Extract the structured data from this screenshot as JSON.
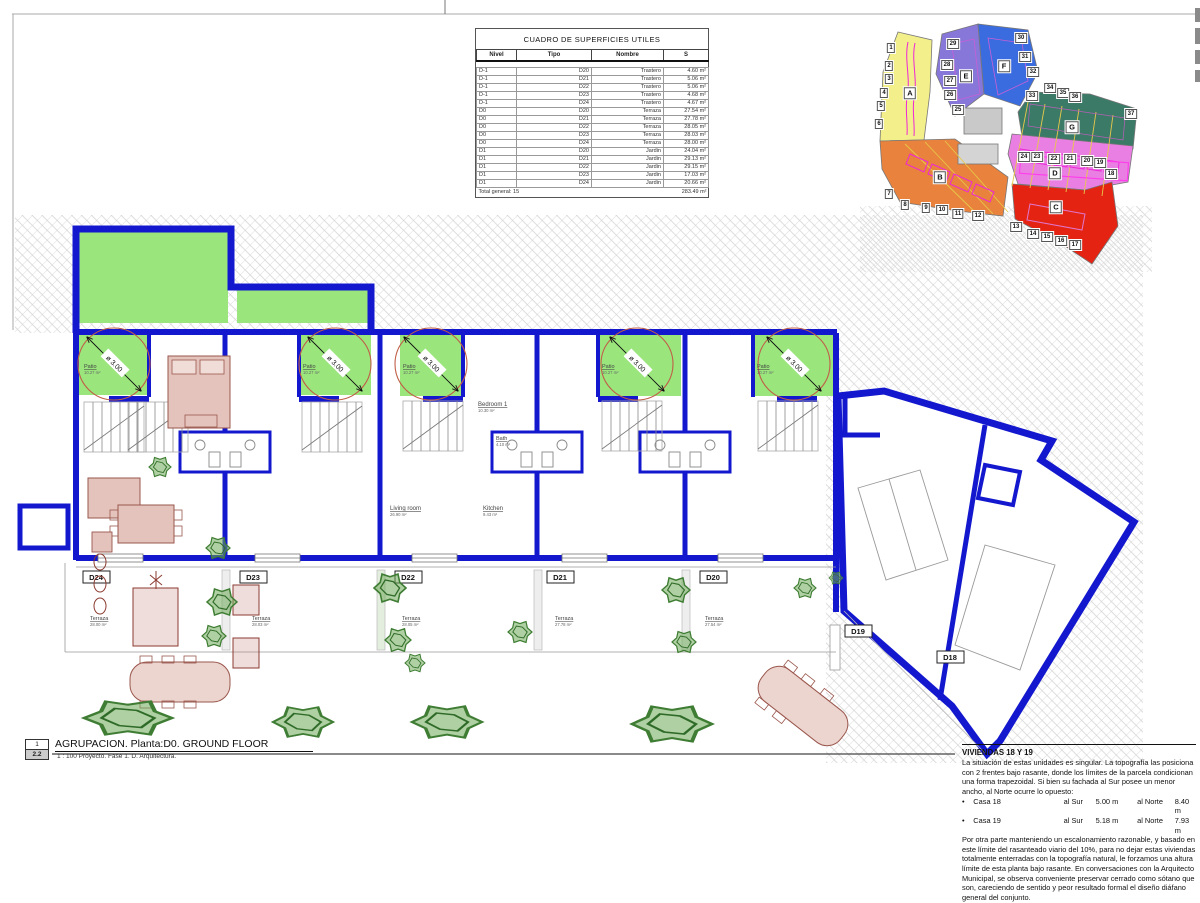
{
  "table": {
    "title": "CUADRO DE SUPERFICIES UTILES",
    "headers": [
      "Nivel",
      "Tipo",
      "Nombre",
      "S"
    ],
    "rows": [
      [
        "D-1",
        "D20",
        "Trastero",
        "4.60 m²"
      ],
      [
        "D-1",
        "D21",
        "Trastero",
        "5.06 m²"
      ],
      [
        "D-1",
        "D22",
        "Trastero",
        "5.06 m²"
      ],
      [
        "D-1",
        "D23",
        "Trastero",
        "4.68 m²"
      ],
      [
        "D-1",
        "D24",
        "Trastero",
        "4.67 m²"
      ],
      [
        "D0",
        "D20",
        "Terraza",
        "27.54 m²"
      ],
      [
        "D0",
        "D21",
        "Terraza",
        "27.78 m²"
      ],
      [
        "D0",
        "D22",
        "Terraza",
        "28.05 m²"
      ],
      [
        "D0",
        "D23",
        "Terraza",
        "28.03 m²"
      ],
      [
        "D0",
        "D24",
        "Terraza",
        "28.00 m²"
      ],
      [
        "D1",
        "D20",
        "Jardin",
        "24.04 m²"
      ],
      [
        "D1",
        "D21",
        "Jardin",
        "29.13 m²"
      ],
      [
        "D1",
        "D22",
        "Jardin",
        "29.15 m²"
      ],
      [
        "D1",
        "D23",
        "Jardin",
        "17.03 m²"
      ],
      [
        "D1",
        "D24",
        "Jardin",
        "20.66 m²"
      ]
    ],
    "total_label": "Total general: 15",
    "total_value": "283.49 m²"
  },
  "site_map": {
    "zones": [
      {
        "letter": "A",
        "color": "#f3ef8a",
        "x": 50,
        "y": 79
      },
      {
        "letter": "B",
        "color": "#e8823c",
        "x": 80,
        "y": 163
      },
      {
        "letter": "C",
        "color": "#e42313",
        "x": 196,
        "y": 193
      },
      {
        "letter": "D",
        "color": "#e97fe3",
        "x": 195,
        "y": 159
      },
      {
        "letter": "E",
        "color": "#8677d8",
        "x": 106,
        "y": 62
      },
      {
        "letter": "F",
        "color": "#3a6ce0",
        "x": 144,
        "y": 52
      },
      {
        "letter": "G",
        "color": "#3c7a68",
        "x": 212,
        "y": 113
      }
    ],
    "plots": [
      {
        "n": "1",
        "x": 31,
        "y": 34
      },
      {
        "n": "2",
        "x": 29,
        "y": 52
      },
      {
        "n": "3",
        "x": 29,
        "y": 65
      },
      {
        "n": "4",
        "x": 24,
        "y": 79
      },
      {
        "n": "5",
        "x": 21,
        "y": 92
      },
      {
        "n": "6",
        "x": 19,
        "y": 110
      },
      {
        "n": "7",
        "x": 29,
        "y": 180
      },
      {
        "n": "8",
        "x": 45,
        "y": 191
      },
      {
        "n": "9",
        "x": 66,
        "y": 194
      },
      {
        "n": "10",
        "x": 82,
        "y": 196
      },
      {
        "n": "11",
        "x": 98,
        "y": 200
      },
      {
        "n": "12",
        "x": 118,
        "y": 202
      },
      {
        "n": "13",
        "x": 156,
        "y": 213
      },
      {
        "n": "14",
        "x": 173,
        "y": 220
      },
      {
        "n": "15",
        "x": 187,
        "y": 223
      },
      {
        "n": "16",
        "x": 201,
        "y": 227
      },
      {
        "n": "17",
        "x": 215,
        "y": 231
      },
      {
        "n": "18",
        "x": 251,
        "y": 160
      },
      {
        "n": "19",
        "x": 240,
        "y": 149
      },
      {
        "n": "20",
        "x": 227,
        "y": 147
      },
      {
        "n": "21",
        "x": 210,
        "y": 145
      },
      {
        "n": "22",
        "x": 194,
        "y": 145
      },
      {
        "n": "23",
        "x": 177,
        "y": 143
      },
      {
        "n": "24",
        "x": 164,
        "y": 143
      },
      {
        "n": "25",
        "x": 98,
        "y": 96
      },
      {
        "n": "26",
        "x": 90,
        "y": 81
      },
      {
        "n": "27",
        "x": 90,
        "y": 67
      },
      {
        "n": "28",
        "x": 87,
        "y": 51
      },
      {
        "n": "29",
        "x": 93,
        "y": 30
      },
      {
        "n": "30",
        "x": 161,
        "y": 24
      },
      {
        "n": "31",
        "x": 165,
        "y": 43
      },
      {
        "n": "32",
        "x": 173,
        "y": 58
      },
      {
        "n": "33",
        "x": 172,
        "y": 82
      },
      {
        "n": "34",
        "x": 190,
        "y": 74
      },
      {
        "n": "35",
        "x": 203,
        "y": 79
      },
      {
        "n": "36",
        "x": 215,
        "y": 83
      },
      {
        "n": "37",
        "x": 271,
        "y": 100
      }
    ]
  },
  "plan": {
    "patio": {
      "label": "Patio",
      "area": "10.27 m²",
      "diameter": "ø 3.00"
    },
    "rooms": {
      "bedroom": {
        "label": "Bedroom 1",
        "area": "10.30 m²"
      },
      "bath": {
        "label": "Bath",
        "area": "4.10 m²"
      },
      "living": {
        "label": "Living room",
        "area": "26.90 m²"
      },
      "kitchen": {
        "label": "Kitchen",
        "area": "9.43 m²"
      }
    },
    "terraza_label": "Terraza",
    "units": [
      {
        "id": "D24",
        "terrace_area": "28.00 m²"
      },
      {
        "id": "D23",
        "terrace_area": "28.03 m²"
      },
      {
        "id": "D22",
        "terrace_area": "28.05 m²"
      },
      {
        "id": "D21",
        "terrace_area": "27.78 m²"
      },
      {
        "id": "D20",
        "terrace_area": "27.54 m²"
      },
      {
        "id": "D19"
      },
      {
        "id": "D18"
      }
    ],
    "colors": {
      "wall_blue": "#1318ce",
      "garden_green": "#9ae67d",
      "circle_red": "#c05f48",
      "tree_green": "#3e7d33",
      "furniture": "#9a574d",
      "hatch_gray": "#cfcfcf"
    }
  },
  "title_block": {
    "index_top": "1",
    "index_bottom": "2.2",
    "title": "AGRUPACION. Planta:D0. GROUND FLOOR",
    "scale_line": "1 : 100 Proyecto. Fase 1. D. Arquitectura."
  },
  "notes": {
    "title": "VIVIENDAS 18 Y 19",
    "para1": "La situación de estas unidades es singular. La topografía las posiciona con 2 frentes bajo rasante, donde los límites de la parcela condicionan una forma trapezoidal. Si bien su fachada al Sur posee un menor ancho, al Norte ocurre lo opuesto:",
    "bullet": "•",
    "casas": [
      {
        "name": "Casa 18",
        "sur_label": "al Sur",
        "sur": "5.00 m",
        "norte_label": "al Norte",
        "norte": "8.40 m"
      },
      {
        "name": "Casa 19",
        "sur_label": "al Sur",
        "sur": "5.18 m",
        "norte_label": "al Norte",
        "norte": "7.93 m"
      }
    ],
    "para2": "Por otra parte manteniendo un escalonamiento razonable, y basado en este límite del rasanteado viario del 10%, para no dejar estas viviendas totalmente enterradas con la topografía natural, le forzamos una altura límite de esta planta bajo rasante. En conversaciones con la Arquitecto Municipal, se observa conveniente preservar cerrado como sótano que son, careciendo de sentido y peor resultado formal el diseño diáfano general del conjunto.",
    "bullet2": "Modificación recogida en los planos sustitutivos 2D.2.1 y 2D.2.2 del archivo 3.2_A2.pdf"
  }
}
